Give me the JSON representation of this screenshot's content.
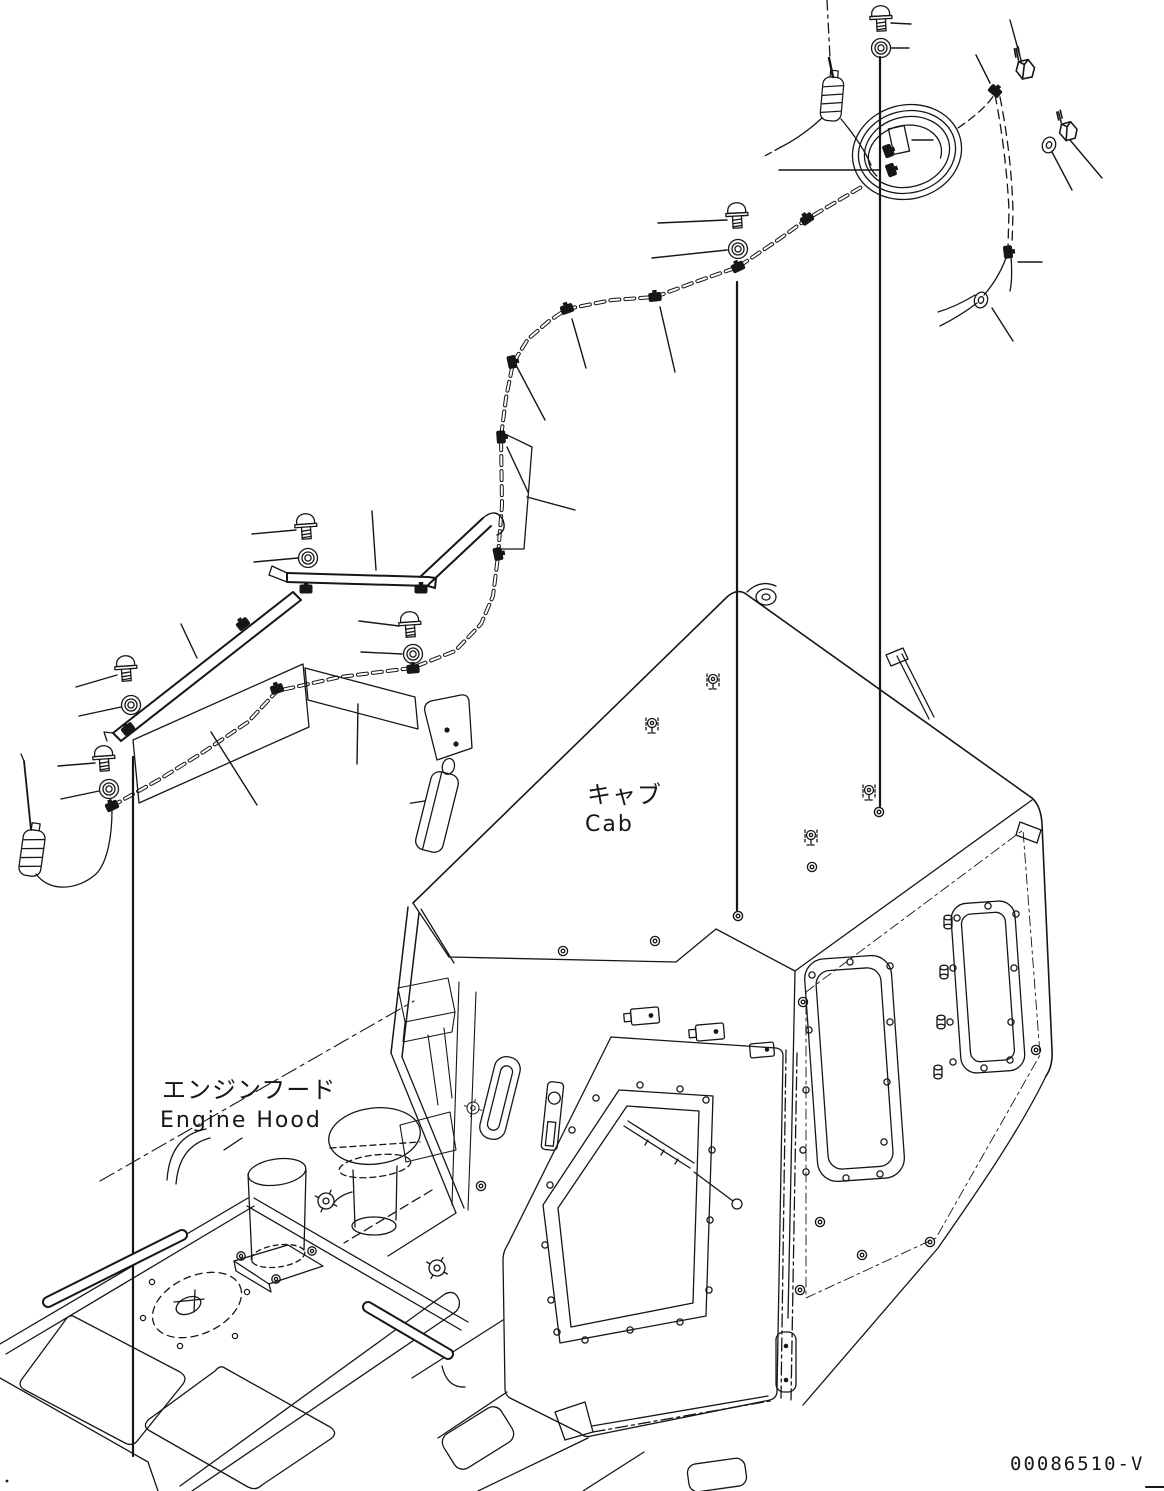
{
  "diagram": {
    "labels": {
      "cab": {
        "jp": "キャブ",
        "en": "Cab"
      },
      "engine_hood": {
        "jp": "エンジンフード",
        "en": "Engine Hood"
      }
    },
    "drawing_number": "00086510-V",
    "colors": {
      "line": "#161616",
      "background": "#ffffff"
    },
    "parts_depicted": [
      "rod antenna (left)",
      "rod antenna (right)",
      "coiled antenna cable",
      "wiring harness with cable clips",
      "mounting brackets and cover plates",
      "flanged bolts",
      "washers",
      "hex bolts",
      "grommets",
      "operator cab with door window and wiper",
      "engine hood with air cleaner and exhaust stack"
    ]
  }
}
